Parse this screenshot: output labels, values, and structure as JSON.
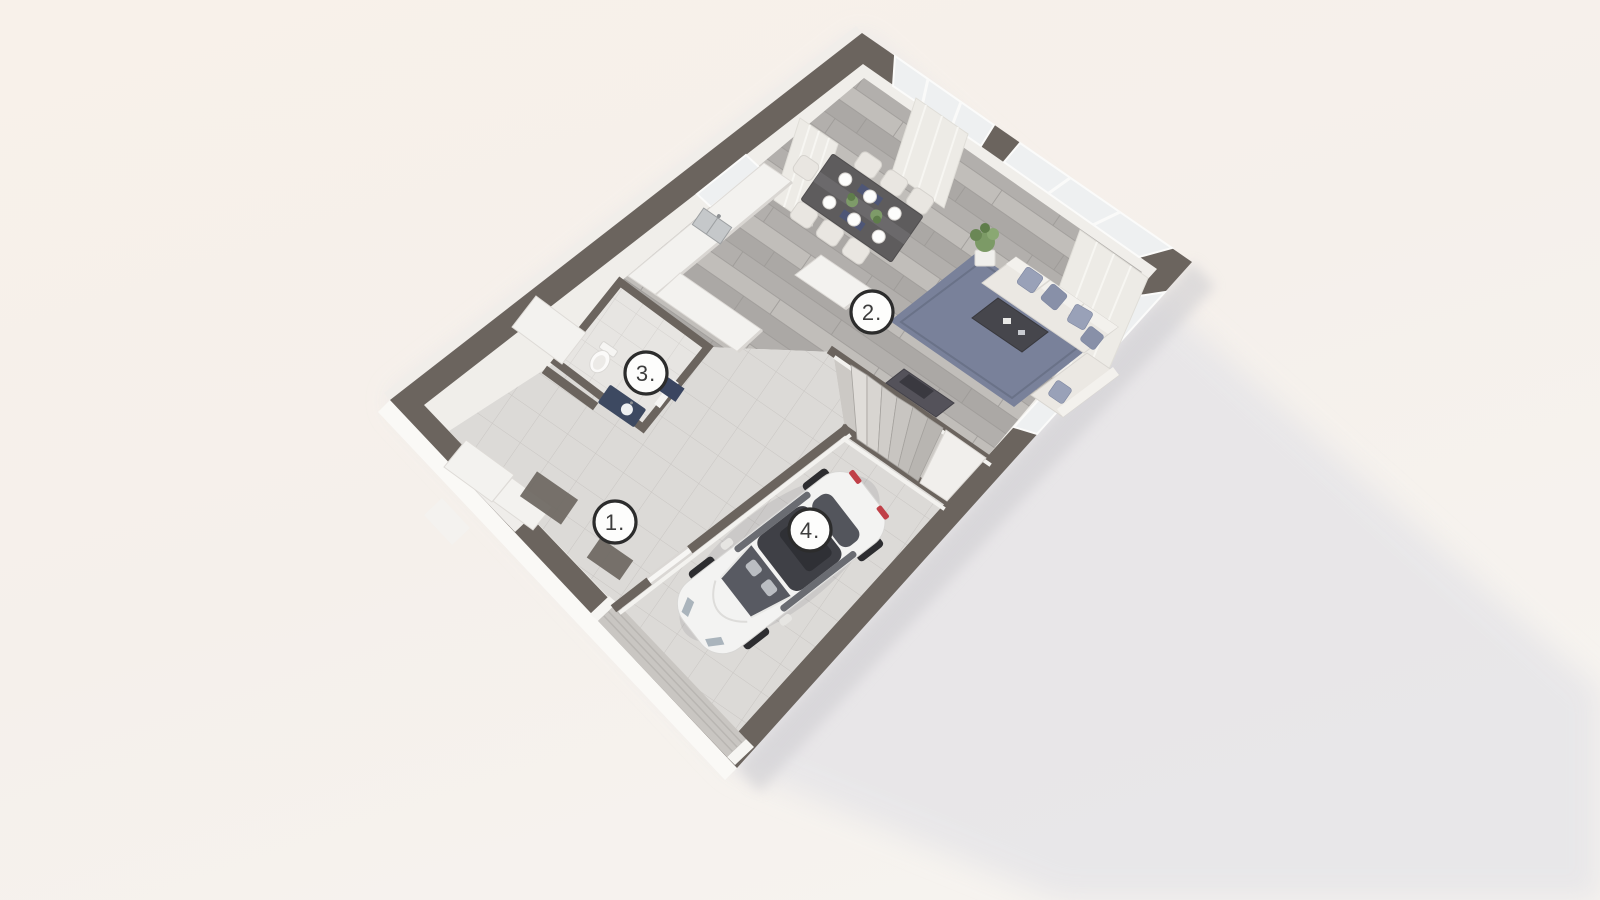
{
  "markers": [
    {
      "room": "hallway-entrance",
      "label": "1."
    },
    {
      "room": "living-dining-kitchen",
      "label": "2."
    },
    {
      "room": "bathroom",
      "label": "3."
    },
    {
      "room": "garage",
      "label": "4."
    }
  ],
  "scene": {
    "description": "3D top-down dollhouse floor plan render of a house level with garage",
    "colors": {
      "background": "#f6f0ea",
      "cast_shadow": "#e6e5e8",
      "wall_top": "#6b645e",
      "wall_face": "#f0eeea",
      "wood_floor": "#b7b4b1",
      "tile_floor": "#dcdad7",
      "bath_tile": "#e7e5e2",
      "rug": "#79819a",
      "sofa": "#ebe8e3",
      "pillow": "#99a1b8",
      "dining_table": "#5e5c5d",
      "car_body": "#f3f3f2",
      "car_roof": "#3f4046",
      "garage_door": "#c9c6c2",
      "vanity_top": "#3d4961",
      "plant": "#7c9a66",
      "marker_ring": "#2c2c2c",
      "marker_fill": "#fdfdfc",
      "marker_text": "#3d3d3d"
    }
  }
}
